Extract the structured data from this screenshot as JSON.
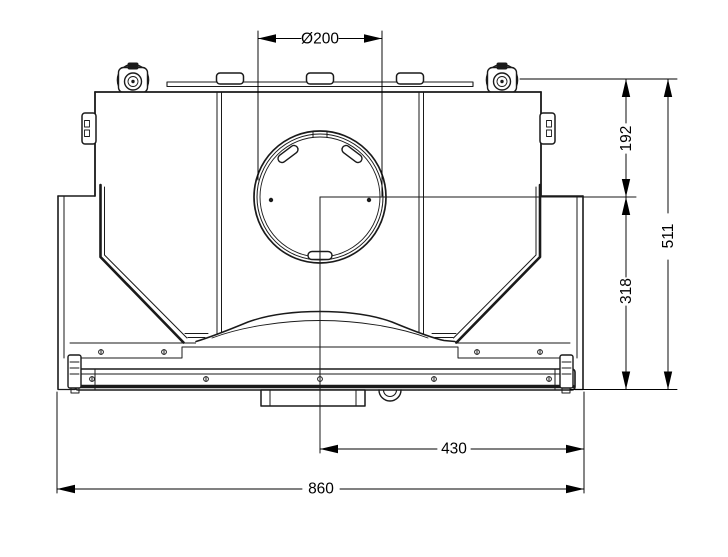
{
  "drawing": {
    "background": "#ffffff",
    "line_color": "#1a1a1a",
    "dims": {
      "dia200": {
        "label": "Ø200"
      },
      "v192": {
        "label": "192"
      },
      "v511": {
        "label": "511"
      },
      "v318": {
        "label": "318"
      },
      "h430": {
        "label": "430"
      },
      "h860": {
        "label": "860"
      }
    }
  }
}
